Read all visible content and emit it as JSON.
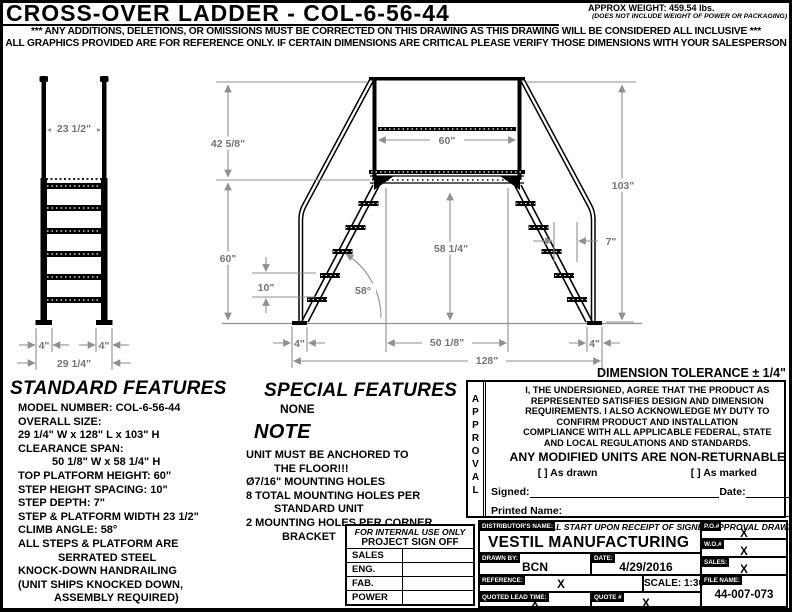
{
  "header": {
    "title": "CROSS-OVER LADDER - COL-6-56-44",
    "weight": "APPROX WEIGHT: 459.54 lbs.",
    "weight_note": "(DOES NOT INCLUDE WEIGHT OF POWER OR PACKAGING)",
    "disclaimer1": "*** ANY ADDITIONS, DELETIONS, OR OMISSIONS MUST BE CORRECTED ON THIS DRAWING AS THIS DRAWING WILL BE CONSIDERED ALL INCLUSIVE ***",
    "disclaimer2": "ALL GRAPHICS PROVIDED ARE FOR REFERENCE ONLY. IF CERTAIN DIMENSIONS ARE CRITICAL PLEASE VERIFY THOSE DIMENSIONS WITH YOUR SALESPERSON"
  },
  "tolerance_note": "DIMENSION TOLERANCE ± 1/4\"",
  "drawing": {
    "front_view": {
      "top_width": "23 1/2\"",
      "foot_left": "4\"",
      "foot_right": "4\"",
      "overall_width": "29 1/4\""
    },
    "side_view": {
      "handrail_rise": "42 5/8\"",
      "platform_length": "60\"",
      "platform_height": "60\"",
      "step_spacing": "10\"",
      "clearance_height": "58 1/4\"",
      "climb_angle": "58°",
      "step_depth": "7\"",
      "total_height": "103\"",
      "foot_left": "4\"",
      "clearance_span": "50 1/8\"",
      "foot_right": "4\"",
      "overall_length": "128\""
    }
  },
  "standard_features": {
    "title": "STANDARD FEATURES",
    "lines": [
      "MODEL NUMBER: COL-6-56-44",
      "OVERALL SIZE:",
      "29 1/4\" W x 128\" L x 103\" H",
      "CLEARANCE SPAN:",
      "50 1/8\" W x 58 1/4\" H",
      "TOP PLATFORM HEIGHT: 60\"",
      "STEP HEIGHT SPACING: 10\"",
      "STEP DEPTH: 7\"",
      "STEP & PLATFORM WIDTH 23 1/2\"",
      "CLIMB ANGLE: 58°",
      "ALL STEPS & PLATFORM ARE",
      "SERRATED STEEL",
      "KNOCK-DOWN HANDRAILING",
      "(UNIT SHIPS KNOCKED DOWN,",
      "ASSEMBLY REQUIRED)"
    ]
  },
  "special_features": {
    "title": "SPECIAL FEATURES",
    "value": "NONE"
  },
  "note": {
    "title": "NOTE",
    "lines": [
      "UNIT MUST BE ANCHORED TO",
      "THE FLOOR!!!",
      "Ø7/16\" MOUNTING HOLES",
      "8 TOTAL MOUNTING HOLES PER",
      "STANDARD UNIT",
      "2 MOUNTING HOLES PER CORNER",
      "BRACKET"
    ]
  },
  "approval": {
    "vertical_label": "APPROVAL",
    "lines": [
      "I, THE UNDERSIGNED, AGREE THAT THE PRODUCT AS",
      "REPRESENTED SATISFIES DESIGN AND DIMENSION",
      "REQUIREMENTS.  I ALSO ACKNOWLEDGE MY DUTY TO",
      "CONFIRM PRODUCT AND INSTALLATION",
      "COMPLIANCE WITH ALL APPLICABLE FEDERAL, STATE",
      "AND LOCAL REGULATIONS AND STANDARDS."
    ],
    "warning": "ANY MODIFIED UNITS ARE NON-RETURNABLE",
    "check_drawn": "[   ] As drawn",
    "check_marked": "[   ] As marked",
    "signed_label": "Signed:",
    "date_label": "Date:",
    "printed_label": "Printed Name:",
    "lead_time": "LEAD TIME WILL START UPON RECEIPT OF SIGNED APPROVAL DRAWING"
  },
  "sign_off": {
    "header1": "FOR INTERNAL USE ONLY",
    "header2": "PROJECT SIGN OFF",
    "rows": [
      "SALES",
      "ENG.",
      "FAB.",
      "POWER"
    ]
  },
  "title_block": {
    "distributor_label": "DISTRIBUTOR'S NAME:",
    "distributor": "VESTIL MANUFACTURING",
    "drawn_by_label": "DRAWN BY:",
    "drawn_by": "BCN",
    "date_label": "DATE:",
    "date": "4/29/2016",
    "reference_label": "REFERENCE:",
    "reference": "X",
    "scale": "SCALE: 1:30",
    "quoted_lead_label": "QUOTED LEAD TIME:",
    "quoted_lead": "X",
    "quote_label": "QUOTE #",
    "quote": "X",
    "po_label": "P.O.#",
    "po": "X",
    "wo_label": "W.O.#",
    "wo": "X",
    "sales_label": "SALES:",
    "sales": "X",
    "file_label": "FILE NAME:",
    "file_name": "44-007-073"
  }
}
